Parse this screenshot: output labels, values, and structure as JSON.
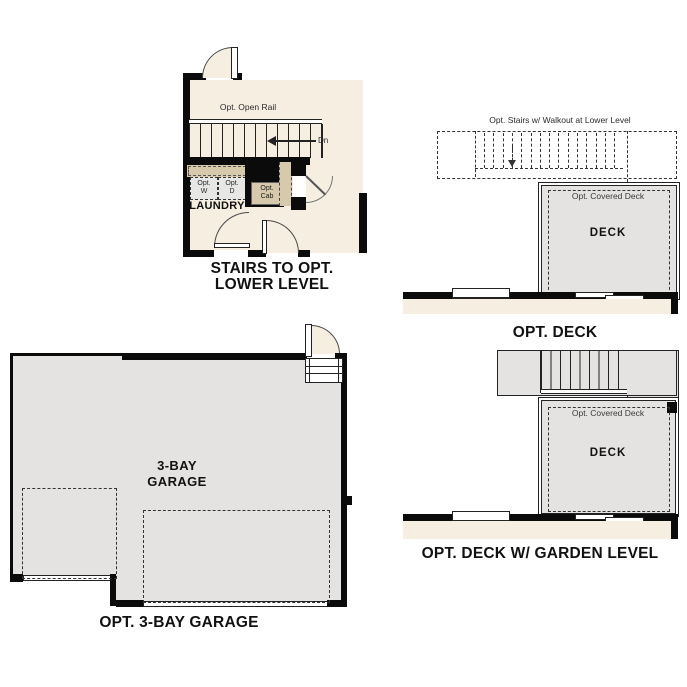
{
  "colors": {
    "paper": "#ffffff",
    "room_beige": "#f5eee1",
    "deck_gray": "#e4e3e1",
    "cabinet_tan": "#d7c9ab",
    "wall_black": "#0b0b0b"
  },
  "plan_stairs": {
    "caption_line1": "STAIRS TO OPT.",
    "caption_line2": "LOWER LEVEL",
    "open_rail_label": "Opt. Open Rail",
    "down_label": "Dn",
    "washer_line1": "Opt.",
    "washer_line2": "W",
    "dryer_line1": "Opt.",
    "dryer_line2": "D",
    "cabinet_line1": "Opt.",
    "cabinet_line2": "Cab",
    "room_label": "LAUNDRY"
  },
  "plan_deck": {
    "caption": "OPT. DECK",
    "stairs_note": "Opt. Stairs w/ Walkout at Lower Level",
    "covered_label": "Opt. Covered Deck",
    "deck_label": "DECK"
  },
  "plan_garage": {
    "caption": "OPT. 3-BAY GARAGE",
    "room_line1": "3-BAY",
    "room_line2": "GARAGE"
  },
  "plan_garden": {
    "caption": "OPT. DECK W/ GARDEN LEVEL",
    "covered_label": "Opt. Covered Deck",
    "deck_label": "DECK"
  }
}
